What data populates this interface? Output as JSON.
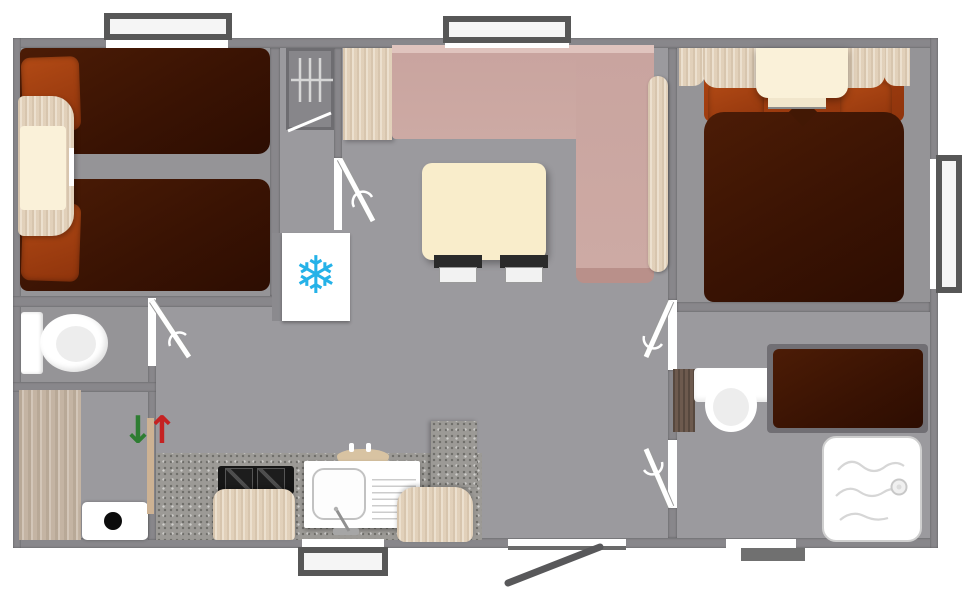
{
  "plan": {
    "type": "floor-plan",
    "view": "top-down",
    "rooms": [
      {
        "id": "bedroom-twin",
        "furniture": [
          "twin-bed",
          "twin-bed",
          "nightstand",
          "wardrobe-with-hanger-rail",
          "storage-cabinet"
        ]
      },
      {
        "id": "wc",
        "furniture": [
          "toilet"
        ]
      },
      {
        "id": "entry-hall",
        "furniture": [
          "wood-floor-panel",
          "water-heater",
          "step-arrows"
        ]
      },
      {
        "id": "kitchen",
        "furniture": [
          "worktop",
          "two-burner-hob",
          "sink-with-drainer",
          "stool",
          "chair",
          "tall-unit",
          "fridge-freezer"
        ]
      },
      {
        "id": "living-dining",
        "furniture": [
          "l-shaped-bench",
          "wood-backrest-shelf",
          "dining-table",
          "stool",
          "stool",
          "side-cabinet"
        ]
      },
      {
        "id": "bedroom-double",
        "furniture": [
          "double-bed",
          "overbed-shelf",
          "corner-wardrobe",
          "corner-wardrobe"
        ]
      },
      {
        "id": "shower-room",
        "furniture": [
          "toilet",
          "single-bed",
          "shower-tray"
        ]
      }
    ],
    "openings": {
      "exterior_windows": 4,
      "exterior_doors": 2,
      "interior_door_leaves": 4
    }
  },
  "icons": {
    "snowflake": "❄",
    "arrow_down": "↓",
    "arrow_up": "↑"
  },
  "colors": {
    "wall": "#88878B",
    "wall_dark": "#6E6D71",
    "floor": "#9B9A9E",
    "bed_maroon": "#3E1504",
    "pillow_rust": "#A23D0E",
    "wood": "#E7D7C1",
    "wood_bright": "#FAF1D9",
    "wood_dark": "#6D5A4E",
    "wood_floor": "#C9BAA9",
    "bench_pink": "#C8A29C",
    "bench_pink_dark": "#B9908A",
    "bench_pink_light": "#E0C4BE",
    "table_cream": "#F9EDCB",
    "counter_speckle": "#9C9A96",
    "cooktop_black": "#161616",
    "fixture_white": "#FFFFFF",
    "snowflake_blue": "#25B2E8",
    "arrow_green": "#2E7D32",
    "arrow_red": "#C52222",
    "entry_door_gray": "#58585A",
    "window_frame": "#575757"
  }
}
